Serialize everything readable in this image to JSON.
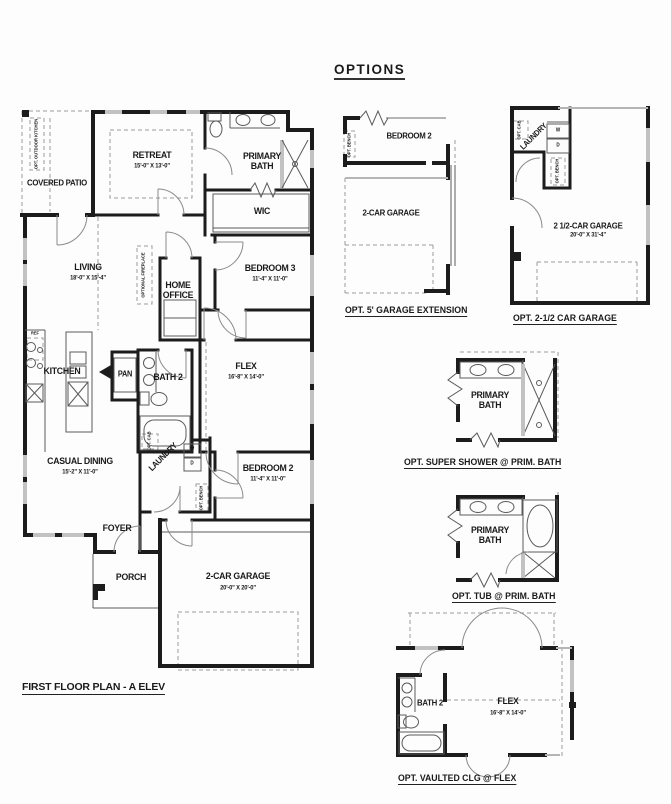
{
  "header": {
    "title": "OPTIONS"
  },
  "main_plan": {
    "title": "FIRST FLOOR PLAN - A ELEV",
    "rooms": {
      "covered_patio": "COVERED PATIO",
      "opt_outdoor_kitchen": "OPT. OUTDOOR KITCHEN",
      "retreat_name": "RETREAT",
      "retreat_dims": "15'-0\" X 13'-0\"",
      "primary_bath": "PRIMARY BATH",
      "wic": "WIC",
      "living_name": "LIVING",
      "living_dims": "18'-0\" X 15'-4\"",
      "optional_fireplace": "OPTIONAL FIREPLACE",
      "home_office": "HOME OFFICE",
      "bedroom3_name": "BEDROOM 3",
      "bedroom3_dims": "11'-4\" X 11'-0\"",
      "kitchen": "KITCHEN",
      "ref": "REF",
      "pan": "PAN",
      "bath2": "BATH 2",
      "flex_name": "FLEX",
      "flex_dims": "16'-8\" X 14'-0\"",
      "casual_dining_name": "CASUAL DINING",
      "casual_dining_dims": "15'-2\" X 11'-0\"",
      "laundry": "LAUNDRY",
      "opt_cab": "OPT. CAB",
      "washer": "W",
      "dryer": "D",
      "bedroom2_name": "BEDROOM 2",
      "bedroom2_dims": "11'-4\" X 11'-0\"",
      "opt_bench": "OPT. BENCH",
      "foyer": "FOYER",
      "porch": "PORCH",
      "garage_name": "2-CAR GARAGE",
      "garage_dims": "20'-0\" X 20'-0\""
    }
  },
  "options": [
    {
      "caption": "OPT. 5' GARAGE EXTENSION",
      "rooms": {
        "bedroom2": "BEDROOM 2",
        "garage": "2-CAR GARAGE",
        "opt_bench": "OPT. BENCH"
      }
    },
    {
      "caption": "OPT. 2-1/2 CAR GARAGE",
      "rooms": {
        "laundry": "LAUNDRY",
        "opt_cab": "OPT. CAB",
        "washer": "W",
        "dryer": "D",
        "opt_bench": "OPT. BENCH",
        "garage_name": "2 1/2-CAR GARAGE",
        "garage_dims": "20'-0\" X 31'-4\""
      }
    },
    {
      "caption": "OPT. SUPER SHOWER @ PRIM. BATH",
      "rooms": {
        "primary_bath": "PRIMARY BATH"
      }
    },
    {
      "caption": "OPT. TUB @ PRIM. BATH",
      "rooms": {
        "primary_bath": "PRIMARY BATH"
      }
    },
    {
      "caption": "OPT. VAULTED CLG @ FLEX",
      "rooms": {
        "bath2": "BATH 2",
        "flex_name": "FLEX",
        "flex_dims": "16'-8\" X 14'-0\""
      }
    }
  ]
}
